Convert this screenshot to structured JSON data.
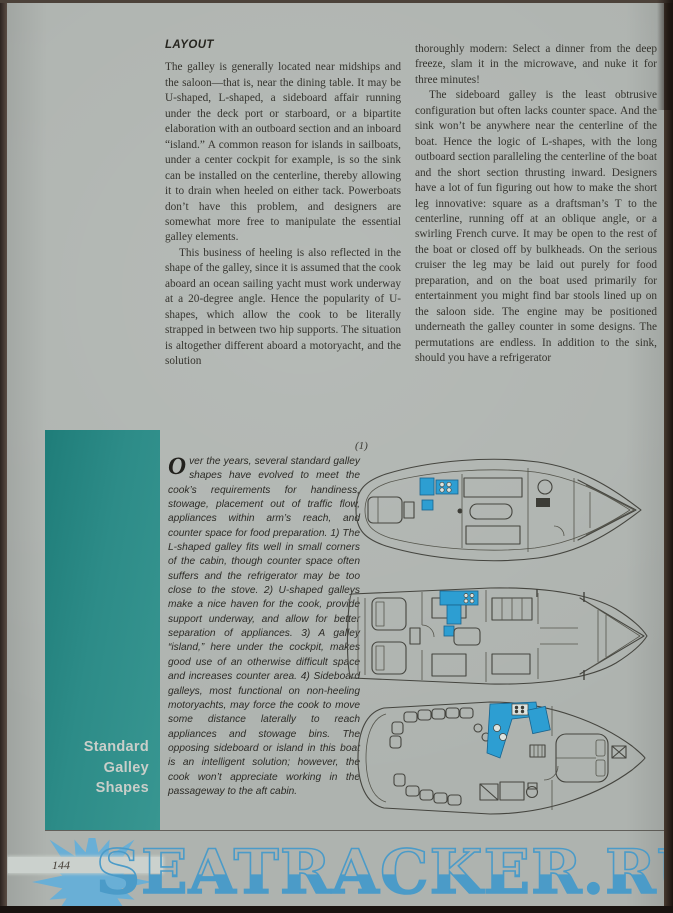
{
  "page": {
    "number": "144",
    "watermark": "SEATRACKER.RU"
  },
  "article": {
    "heading": "LAYOUT",
    "left_column": {
      "paragraphs": [
        "The galley is generally located near midships and the saloon—that is, near the dining table. It may be U-shaped, L-shaped, a sideboard affair running under the deck port or starboard, or a bipartite elaboration with an outboard section and an inboard “island.” A common reason for islands in sailboats, under a center cockpit for example, is so the sink can be installed on the centerline, thereby allowing it to drain when heeled on either tack. Powerboats don’t have this problem, and designers are somewhat more free to manipulate the essential galley elements.",
        "This business of heeling is also reflected in the shape of the galley, since it is assumed that the cook aboard an ocean sailing yacht must work underway at a 20-degree angle. Hence the popularity of U-shapes, which allow the cook to be literally strapped in between two hip supports. The situation is altogether different aboard a motoryacht, and the solution"
      ]
    },
    "right_column": {
      "paragraphs": [
        "thoroughly modern: Select a dinner from the deep freeze, slam it in the microwave, and nuke it for three minutes!",
        "The sideboard galley is the least obtrusive configuration but often lacks counter space. And the sink won’t be anywhere near the centerline of the boat. Hence the logic of L-shapes, with the long outboard section paralleling the centerline of the boat and the short section thrusting inward. Designers have a lot of fun figuring out how to make the short leg innovative: square as a draftsman’s T to the centerline, running off at an oblique angle, or a swirling French curve. It may be open to the rest of the boat or closed off by bulkheads. On the serious cruiser the leg may be laid out purely for food preparation, and on the boat used primarily for entertainment you might find bar stools lined up on the saloon side. The engine may be positioned underneath the galley counter in some designs. The permutations are endless. In addition to the sink, should you have a refrigerator"
      ]
    }
  },
  "figure": {
    "sidebar_title_lines": [
      "Standard",
      "Galley",
      "Shapes"
    ],
    "caption_dropcap": "O",
    "caption_text": "ver the years, several standard galley shapes have evolved to meet the cook’s requirements for handiness, stowage, placement out of traffic flow, appliances within arm’s reach, and counter space for food preparation. 1) The L-shaped galley fits well in small corners of the cabin, though counter space often suffers and the refrigerator may be too close to the stove. 2) U-shaped galleys make a nice haven for the cook, provide support underway, and allow for better separation of appliances. 3) A galley “island,” here under the cockpit, makes good use of an otherwise difficult space and increases counter area. 4) Sideboard galleys, most functional on non-heeling motoryachts, may force the cook to move some distance laterally to reach appliances and stowage bins. The opposing sideboard or island in this boat is an intelligent solution; however, the cook won’t appreciate working in the passageway to the aft cabin.",
    "diagram_label": "(1)"
  },
  "colors": {
    "paper": "#aeb3af",
    "teal_panel": "#2d8c88",
    "sidebar_title": "#c9cec9",
    "galley_highlight": "#2d9ed2",
    "watermark_blue": "#4b9bc8",
    "sun_logo_blue": "#69afd6",
    "body_text": "#35342e"
  }
}
